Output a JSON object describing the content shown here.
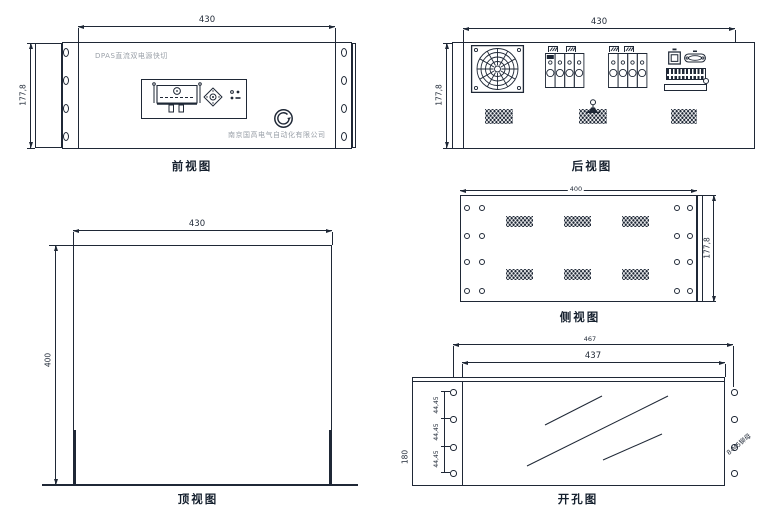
{
  "colors": {
    "ink": "#1f2836",
    "muted": "#9aa0a8"
  },
  "front_view": {
    "caption": "前视图",
    "width_dim": "430",
    "height_dim": "177,8",
    "panel_title": "DPAS直流双电源快切",
    "company_name": "南京国高电气自动化有限公司"
  },
  "rear_view": {
    "caption": "后视图",
    "width_dim": "430",
    "height_dim": "177,8"
  },
  "side_view": {
    "caption": "侧视图",
    "width_dim": "400",
    "height_dim": "177,8"
  },
  "top_view": {
    "caption": "顶视图",
    "width_dim": "430",
    "depth_dim": "400"
  },
  "cutout_view": {
    "caption": "开孔图",
    "outer_width_dim": "467",
    "inner_width_dim": "437",
    "height_dim": "180",
    "hole_pitch_dims": [
      "44,45",
      "44,45",
      "44,45"
    ],
    "hole_note": "8-M5铆母"
  }
}
